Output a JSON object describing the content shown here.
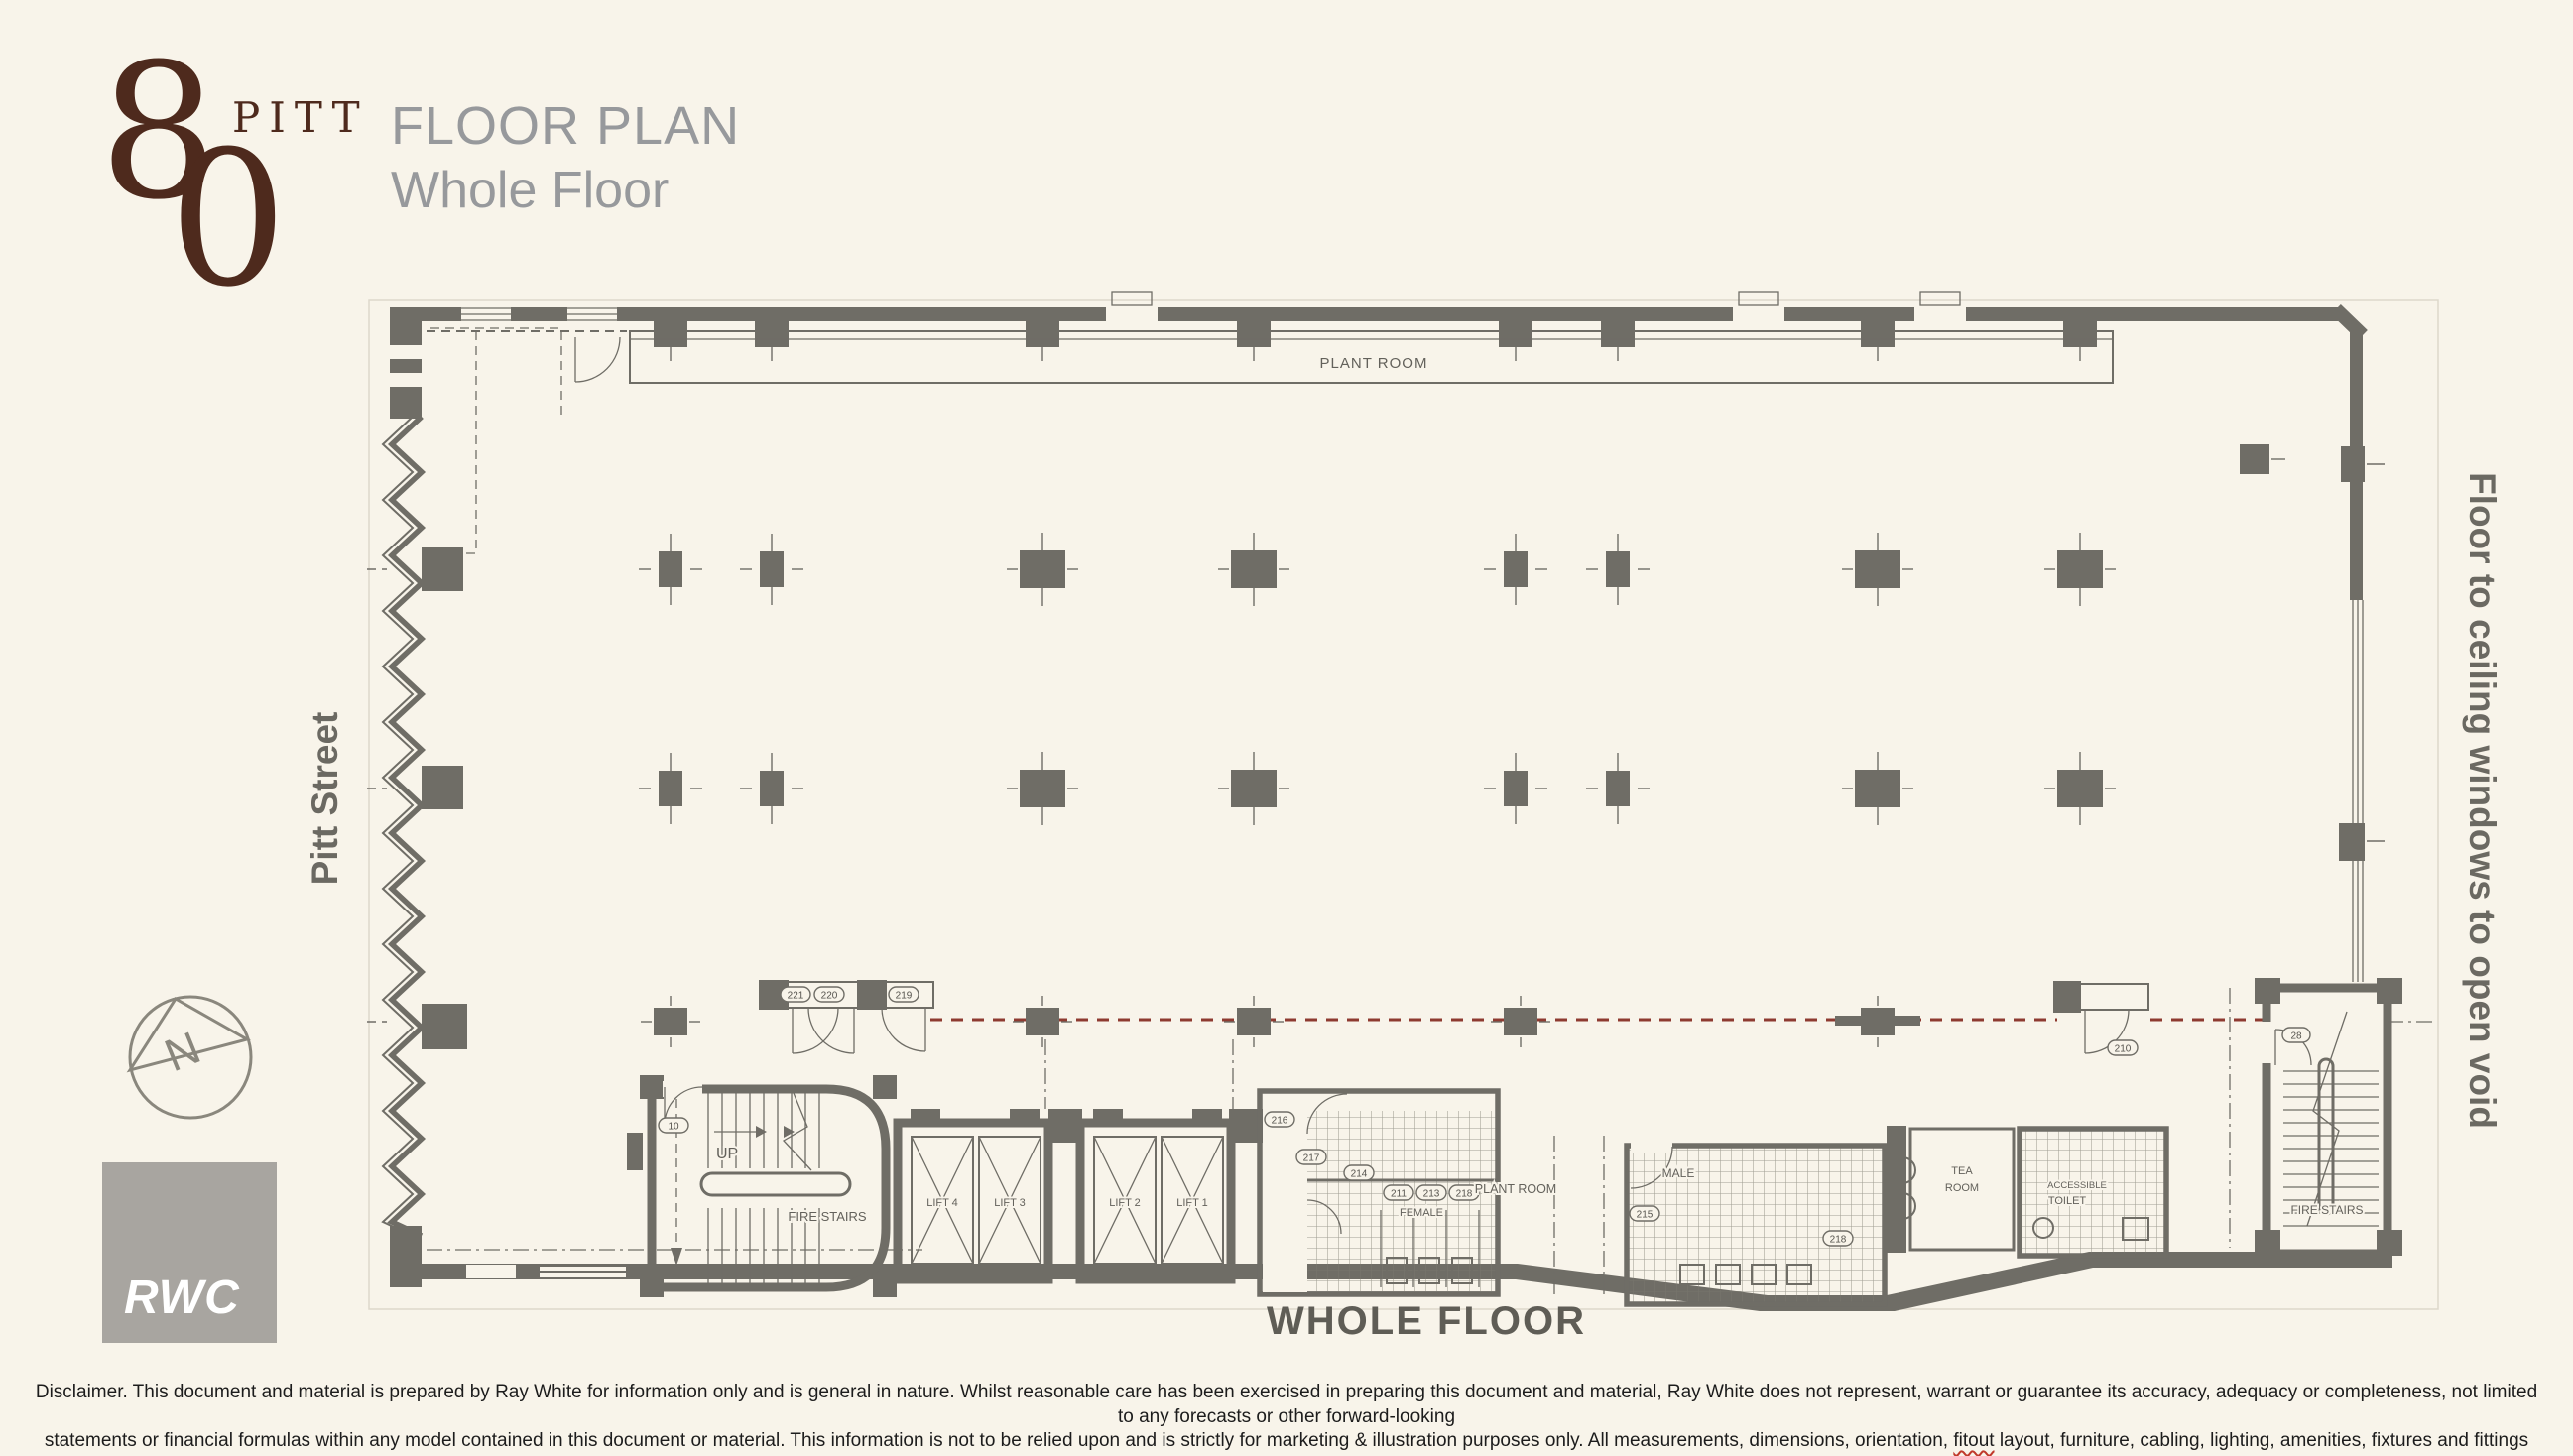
{
  "page": {
    "background": "#f8f4ea"
  },
  "logo": {
    "digit_top": "8",
    "digit_bottom": "0",
    "word": "PITT",
    "color": "#4e2a1d"
  },
  "header": {
    "title": "FLOOR PLAN",
    "subtitle": "Whole Floor"
  },
  "side_labels": {
    "left_street": "Pitt Street",
    "right_note": "Floor to ceiling windows to open void"
  },
  "compass": {
    "letter": "N"
  },
  "agency": {
    "logo": "RWC"
  },
  "plan": {
    "caption": "WHOLE FLOOR",
    "colors": {
      "wall": "#6f6d66",
      "red_dashed_line": "#8e3a30"
    },
    "rooms": {
      "plant_room_top": "PLANT ROOM",
      "up": "UP",
      "fire_stairs_left": "FIRE STAIRS",
      "lift_4": "LIFT 4",
      "lift_3": "LIFT 3",
      "lift_2": "LIFT 2",
      "lift_1": "LIFT 1",
      "female": "FEMALE",
      "plant_room_bottom": "PLANT ROOM",
      "male": "MALE",
      "tea_room_line1": "TEA",
      "tea_room_line2": "ROOM",
      "accessible_line1": "ACCESSIBLE",
      "accessible_line2": "TOILET",
      "fire_stairs_right": "FIRE STAIRS"
    },
    "door_tags": {
      "stair_left_door": "10",
      "lobby_door_1": "221",
      "lobby_door_2": "220",
      "lobby_door_3": "219",
      "female_room_1": "216",
      "female_room_2": "217",
      "female_room_3": "214",
      "female_cubicle_1": "211",
      "female_cubicle_2": "213",
      "female_cubicle_3": "218",
      "male_room_1": "215",
      "male_room_2": "218",
      "corridor_door": "210",
      "stair_right_door": "28"
    }
  },
  "footer": {
    "disclaimer_line1": "Disclaimer. This document and material is prepared by Ray White for information only and is general in nature.  Whilst reasonable care has been exercised in preparing this document and material,  Ray White does not represent, warrant or guarantee its accuracy, adequacy or completeness, not limited to any forecasts or other forward-looking",
    "disclaimer_line2_before": "statements or financial formulas within any model contained in this document or material. This information is not to be relied upon and is strictly for marketing & illustration purposes only. All measurements, dimensions, orientation,",
    "disclaimer_line2_word": "fitout",
    "disclaimer_line2_after": "layout, furniture, cabling, lighting, amenities, fixtures and fittings shown are approximate and not to scale, with",
    "disclaimer_line3": "the quality and condition not guaranteed and your responsibility to evaluate and test."
  }
}
